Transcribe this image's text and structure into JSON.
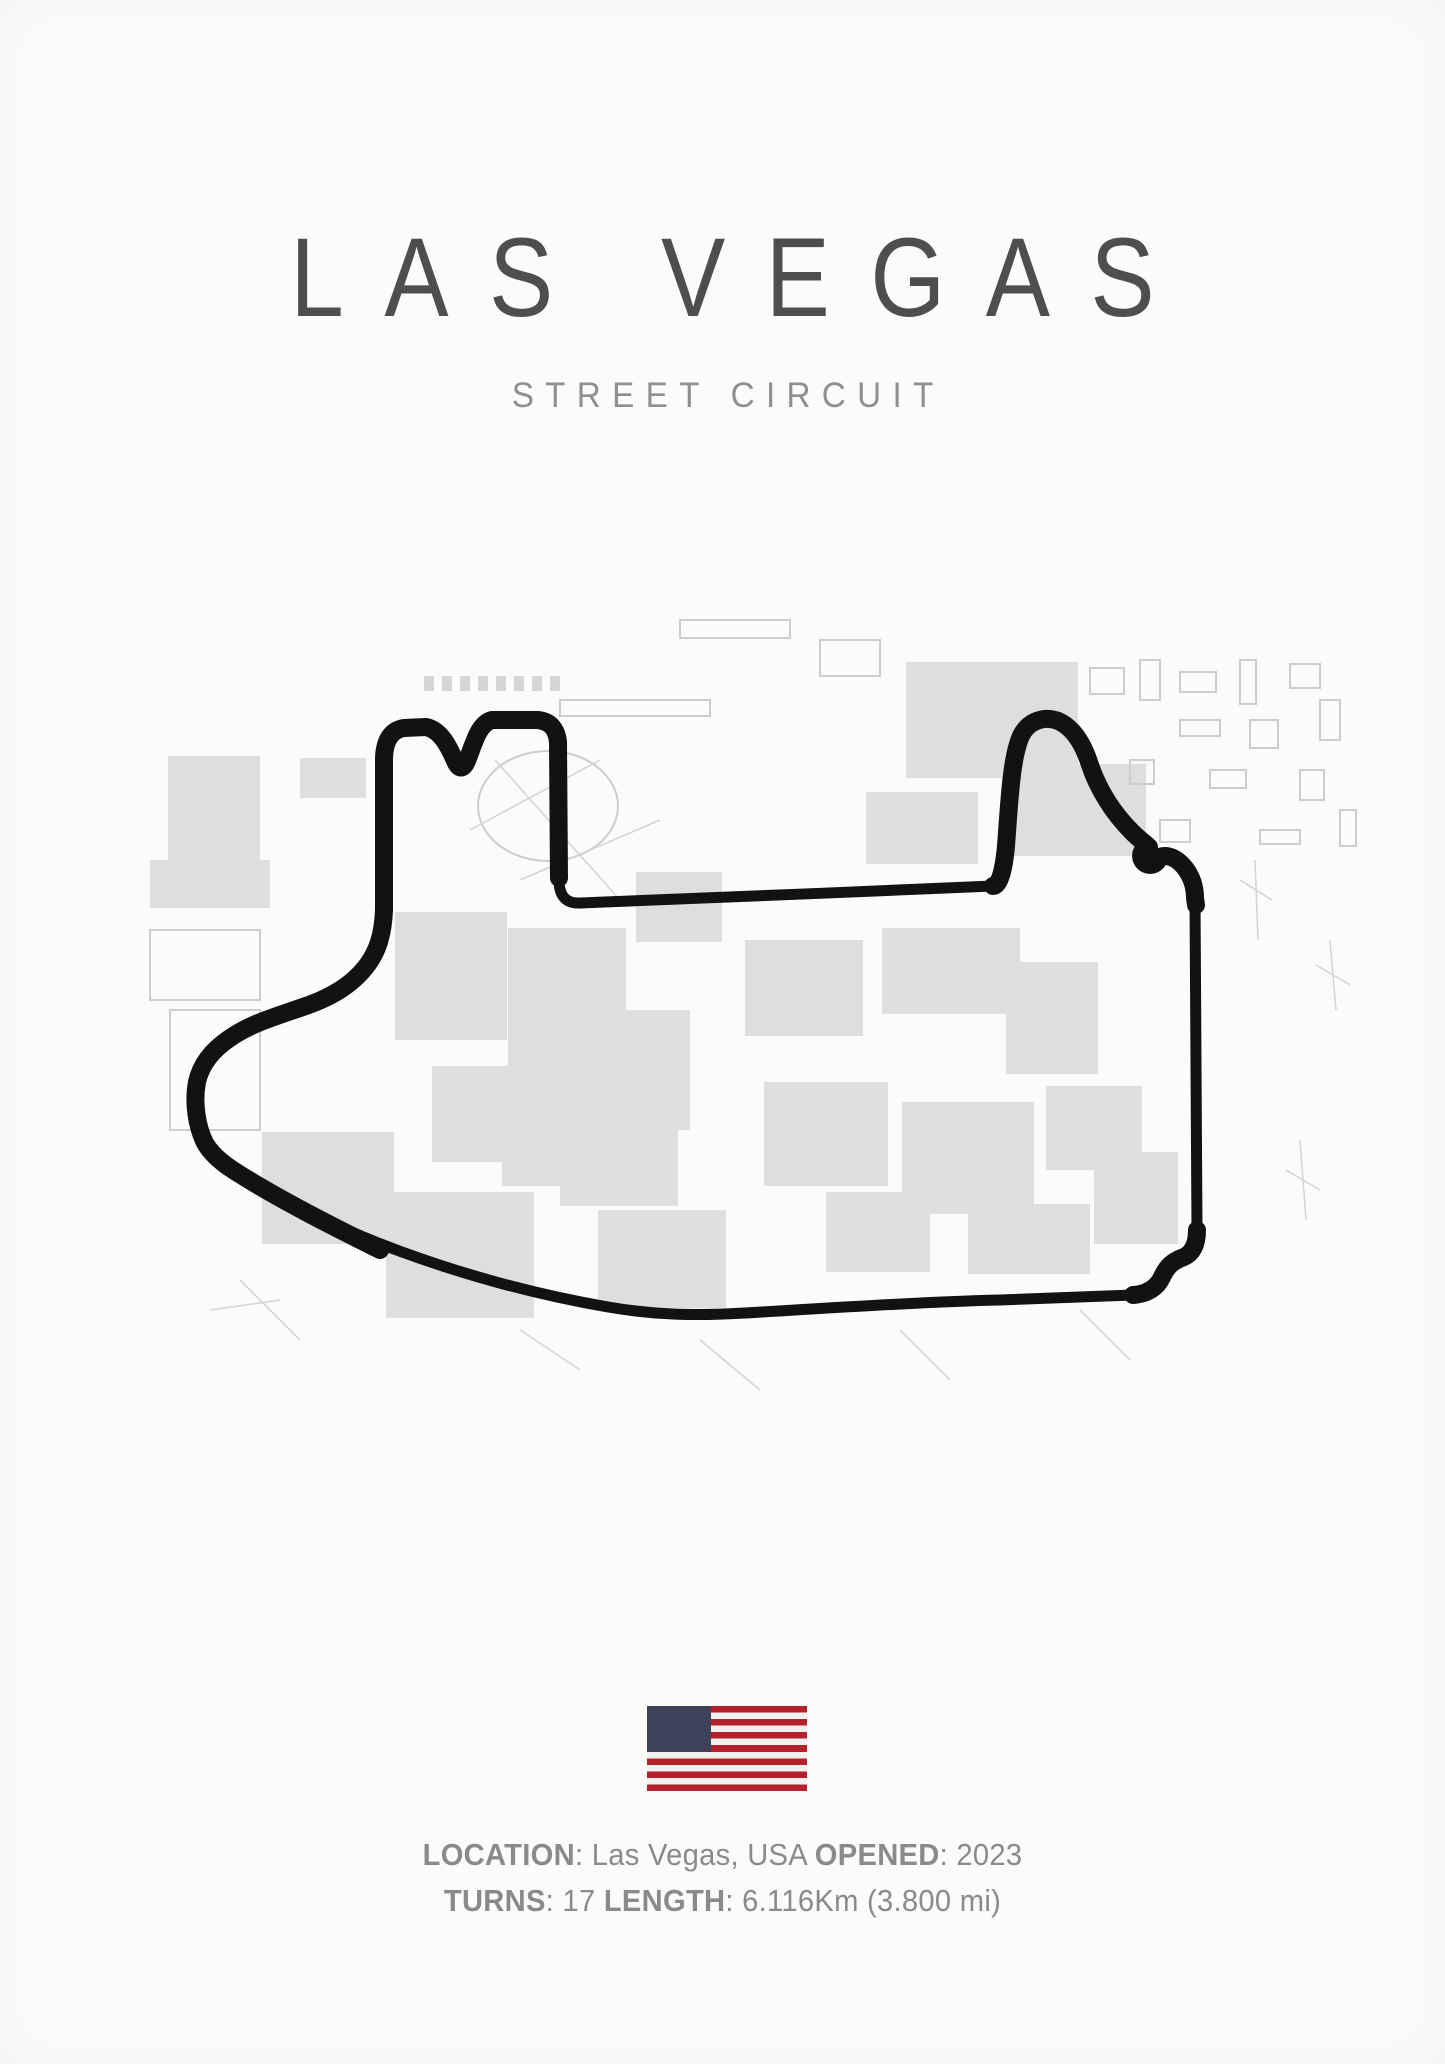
{
  "poster": {
    "title": "LAS VEGAS",
    "subtitle": "STREET CIRCUIT",
    "circuit": {
      "location": "Las Vegas, USA",
      "opened": "2023",
      "turns": "17",
      "length": "6.116Km (3.800 mi)"
    },
    "info": {
      "line1": [
        "LOCATION",
        ": Las Vegas, USA ",
        "OPENED",
        ": 2023"
      ],
      "line2": [
        "TURNS",
        ": 17 ",
        "LENGTH",
        ": 6.116Km (3.800 mi)"
      ]
    },
    "flag": "usa-flag",
    "colors": {
      "background": "#fbfbfa",
      "title": "#4e4e4e",
      "subtitle": "#8f8f8f",
      "info": "#8a8a8a",
      "track": "#121212",
      "flag-canton": "#3e4259",
      "flag-red": "#b3222c",
      "flag-white": "#f2f0ee"
    }
  }
}
